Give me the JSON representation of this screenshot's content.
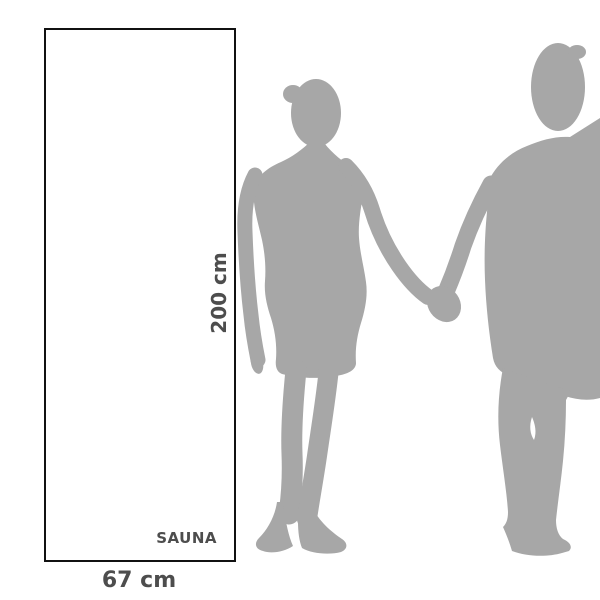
{
  "scene": {
    "background": "#ffffff",
    "description": "Sauna towel size comparison diagram with silhouettes of a couple holding hands"
  },
  "towel": {
    "height_label": "200 cm",
    "width_label": "67 cm",
    "brand_label": "SAUNA",
    "border_color": "#111111",
    "fill_color": "#ffffff",
    "label_color": "#4d4d4d"
  },
  "figures": {
    "description": "man and woman silhouettes holding hands",
    "color": "#a7a7a7"
  }
}
